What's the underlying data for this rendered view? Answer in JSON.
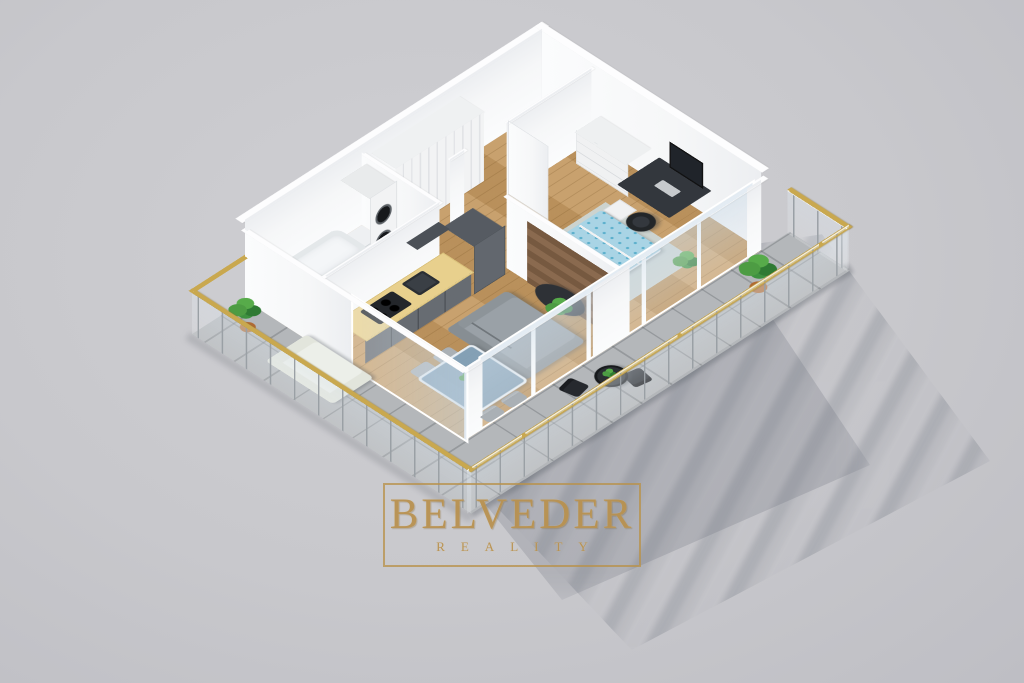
{
  "watermark": {
    "brand": "BELVEDER",
    "tagline": "REALITY"
  },
  "palette": {
    "bg": "#c8c8cc",
    "gold": "#b8914e",
    "gold-light": "#e0c084",
    "rail-gold": "#c9a84f",
    "wall": "#f6f7f8",
    "wood": "#c49a63",
    "tile": "#b4b7ba",
    "bath": "#eef0f2",
    "counter": "#e8d08d",
    "cabinet": "#5a5f66",
    "dark": "#2c2f34",
    "door-dark": "#26282c",
    "bed-blue": "#a9d4e5",
    "bed-dot": "#58aecb",
    "sofa": "#9aa1a7",
    "rug": "#ccd3cf",
    "plant": "#3f9140",
    "pot": "#b06a33",
    "panel-wood": "#8a6a4f"
  },
  "scene": {
    "type": "isometric-floorplan-render",
    "rooms": [
      "bathroom",
      "hallway",
      "kitchen",
      "living-dining",
      "bedroom",
      "balcony"
    ]
  }
}
